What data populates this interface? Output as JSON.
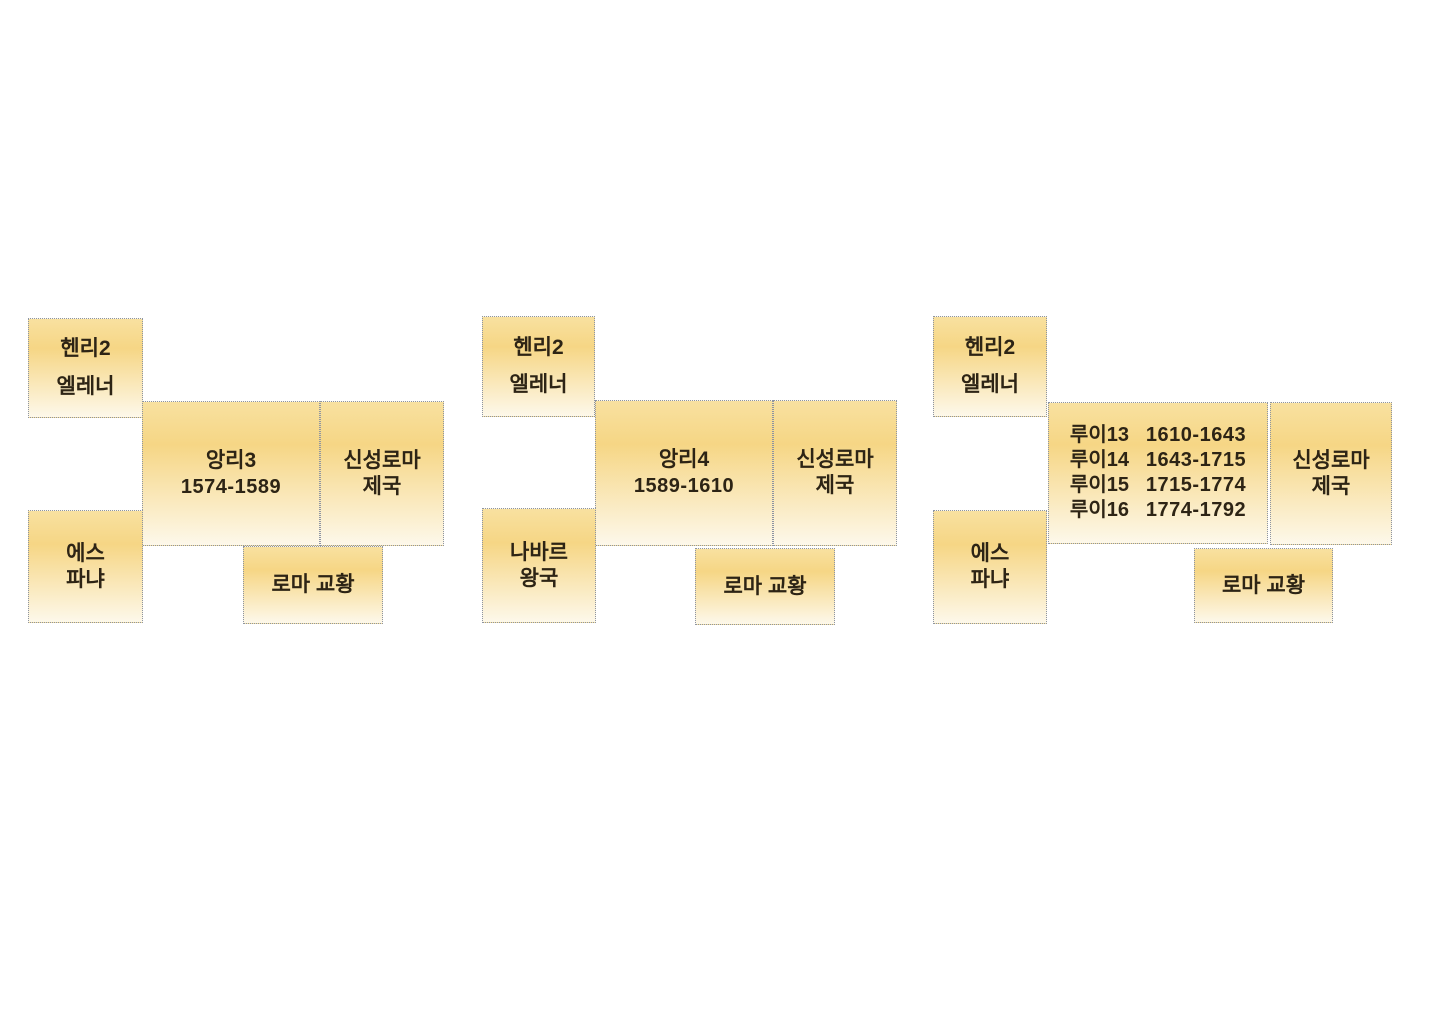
{
  "colors": {
    "background": "#ffffff",
    "box_gradient_top": "#f8e1a0",
    "box_gradient_mid": "#f6d685",
    "box_gradient_bottom": "#fdf8ea",
    "box_border": "#8d94a2",
    "text": "#2d2415"
  },
  "groups": [
    {
      "id": "henri3",
      "henry": {
        "line1": "헨리2",
        "line2": "엘레너"
      },
      "king": {
        "name": "앙리3",
        "years": "1574-1589"
      },
      "empire": {
        "line1": "신성로마",
        "line2": "제국"
      },
      "southwest": {
        "line1": "에스",
        "line2": "파냐"
      },
      "pope": "로마 교황"
    },
    {
      "id": "henri4",
      "henry": {
        "line1": "헨리2",
        "line2": "엘레너"
      },
      "king": {
        "name": "앙리4",
        "years": "1589-1610"
      },
      "empire": {
        "line1": "신성로마",
        "line2": "제국"
      },
      "southwest": {
        "line1": "나바르",
        "line2": "왕국"
      },
      "pope": "로마 교황"
    },
    {
      "id": "louis",
      "henry": {
        "line1": "헨리2",
        "line2": "엘레너"
      },
      "king_rows": [
        {
          "name": "루이13",
          "years": "1610-1643"
        },
        {
          "name": "루이14",
          "years": "1643-1715"
        },
        {
          "name": "루이15",
          "years": "1715-1774"
        },
        {
          "name": "루이16",
          "years": "1774-1792"
        }
      ],
      "empire": {
        "line1": "신성로마",
        "line2": "제국"
      },
      "southwest": {
        "line1": "에스",
        "line2": "파냐"
      },
      "pope": "로마 교황"
    }
  ]
}
